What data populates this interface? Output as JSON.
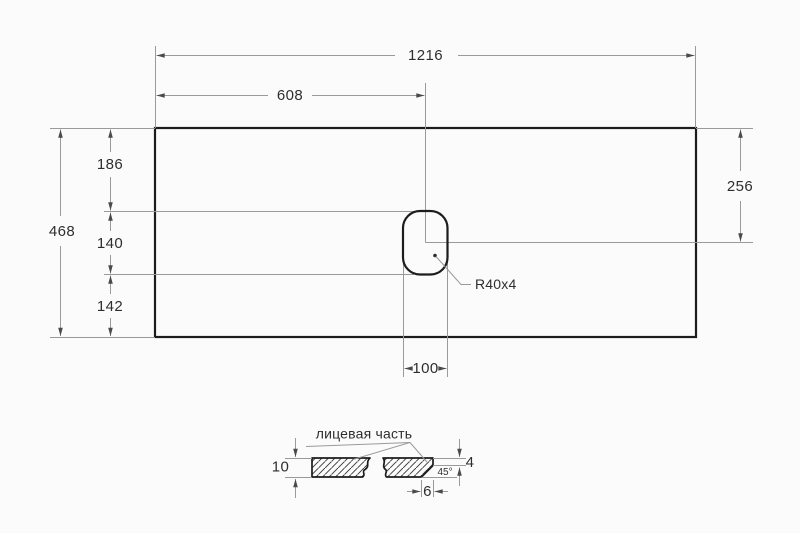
{
  "colors": {
    "background": "#fbfbfb",
    "outline": "#1c1c1c",
    "dimension_lines": "#9a9a9a",
    "arrowheads": "#4a4a4a",
    "text": "#2e2e2e"
  },
  "top_view": {
    "dim_total_width": "1216",
    "dim_center_offset": "608",
    "dim_top_to_hole": "186",
    "dim_hole_height": "140",
    "dim_hole_to_bottom": "142",
    "dim_total_height": "468",
    "dim_right_to_hole_center": "256",
    "dim_hole_width": "100",
    "hole_radius_label": "R40x4"
  },
  "section_view": {
    "face_label": "лицевая часть",
    "dim_thickness": "10",
    "dim_edge_height": "4",
    "dim_chamfer_width": "6",
    "angle_label": "45°"
  }
}
